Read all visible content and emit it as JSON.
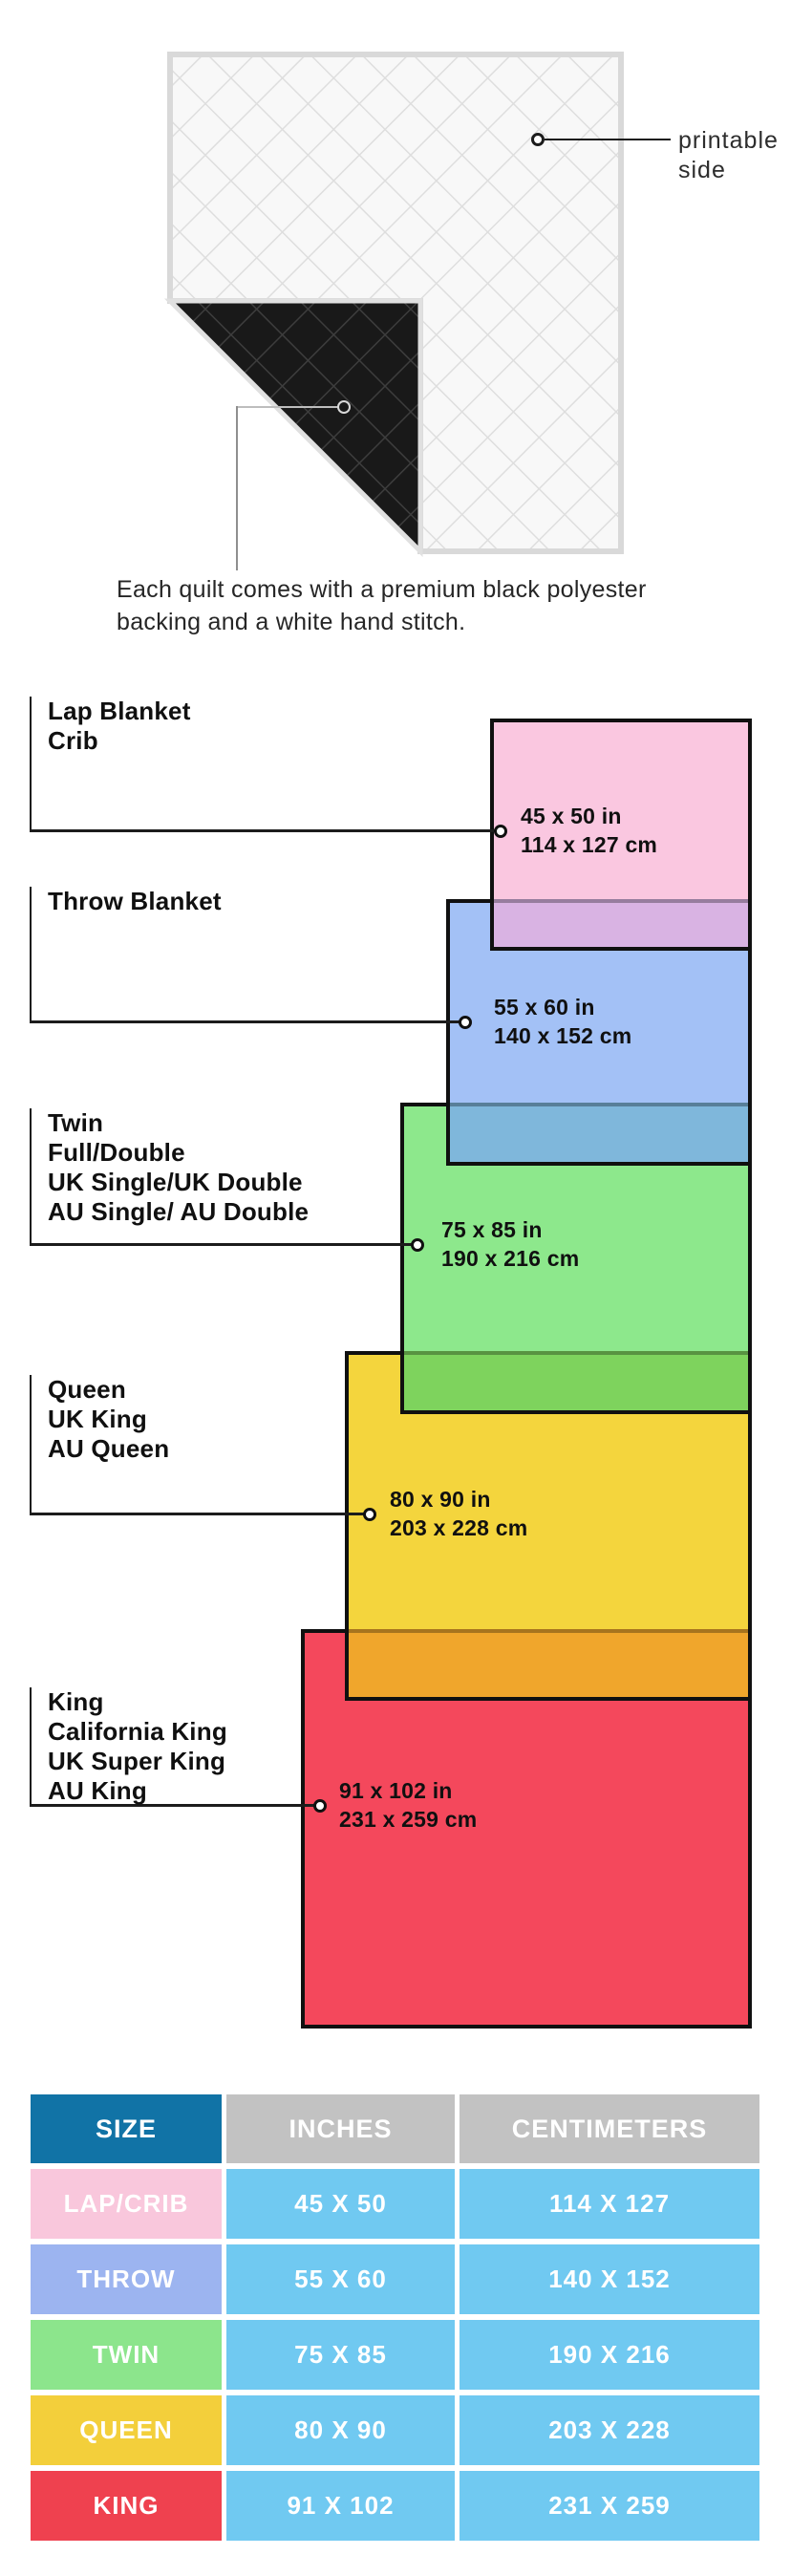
{
  "quilt": {
    "printable_label_line1": "printable",
    "printable_label_line2": "side",
    "caption_line1": "Each quilt comes with a premium black polyester",
    "caption_line2": "backing and a white hand stitch."
  },
  "sizes": [
    {
      "key": "lap-crib",
      "labels": [
        "Lap Blanket",
        "Crib"
      ],
      "inches": "45 x 50 in",
      "cm": "114 x 127 cm",
      "color": "#fac7e0"
    },
    {
      "key": "throw",
      "labels": [
        "Throw Blanket"
      ],
      "inches": "55 x 60 in",
      "cm": "140 x 152 cm",
      "color": "#a3c1f6"
    },
    {
      "key": "twin",
      "labels": [
        "Twin",
        "Full/Double",
        "UK Single/UK Double",
        "AU Single/ AU Double"
      ],
      "inches": "75 x 85 in",
      "cm": "190 x 216 cm",
      "color": "#8de88c"
    },
    {
      "key": "queen",
      "labels": [
        "Queen",
        "UK King",
        "AU Queen"
      ],
      "inches": "80 x 90 in",
      "cm": "203 x 228 cm",
      "color": "#f4d53d"
    },
    {
      "key": "king",
      "labels": [
        "King",
        "California King",
        "UK Super King",
        "AU King"
      ],
      "inches": "91 x 102 in",
      "cm": "231 x 259 cm",
      "color": "#f4485c"
    }
  ],
  "overlap_colors": {
    "pink_over_blue": "#d9b3e3",
    "blue_over_green": "#7fb7db",
    "green_over_yellow": "#7ed35d",
    "yellow_over_red": "#f0a62c"
  },
  "table": {
    "headers": [
      "SIZE",
      "INCHES",
      "CENTIMETERS"
    ],
    "header_colors": {
      "size_bg": "#1173a6",
      "other_bg": "#c2c2c2"
    },
    "data_cell_color": "#70c9f1",
    "rows": [
      {
        "size": "LAP/CRIB",
        "inches": "45 X 50",
        "cm": "114 X 127",
        "label_color": "#f9c7dc"
      },
      {
        "size": "THROW",
        "inches": "55 X 60",
        "cm": "140 X 152",
        "label_color": "#9cb4f0"
      },
      {
        "size": "TWIN",
        "inches": "75 X 85",
        "cm": "190 X 216",
        "label_color": "#8ce58c"
      },
      {
        "size": "QUEEN",
        "inches": "80 X 90",
        "cm": "203 X 228",
        "label_color": "#f3cf3b"
      },
      {
        "size": "KING",
        "inches": "91 X 102",
        "cm": "231 X 259",
        "label_color": "#ef414f"
      }
    ]
  }
}
